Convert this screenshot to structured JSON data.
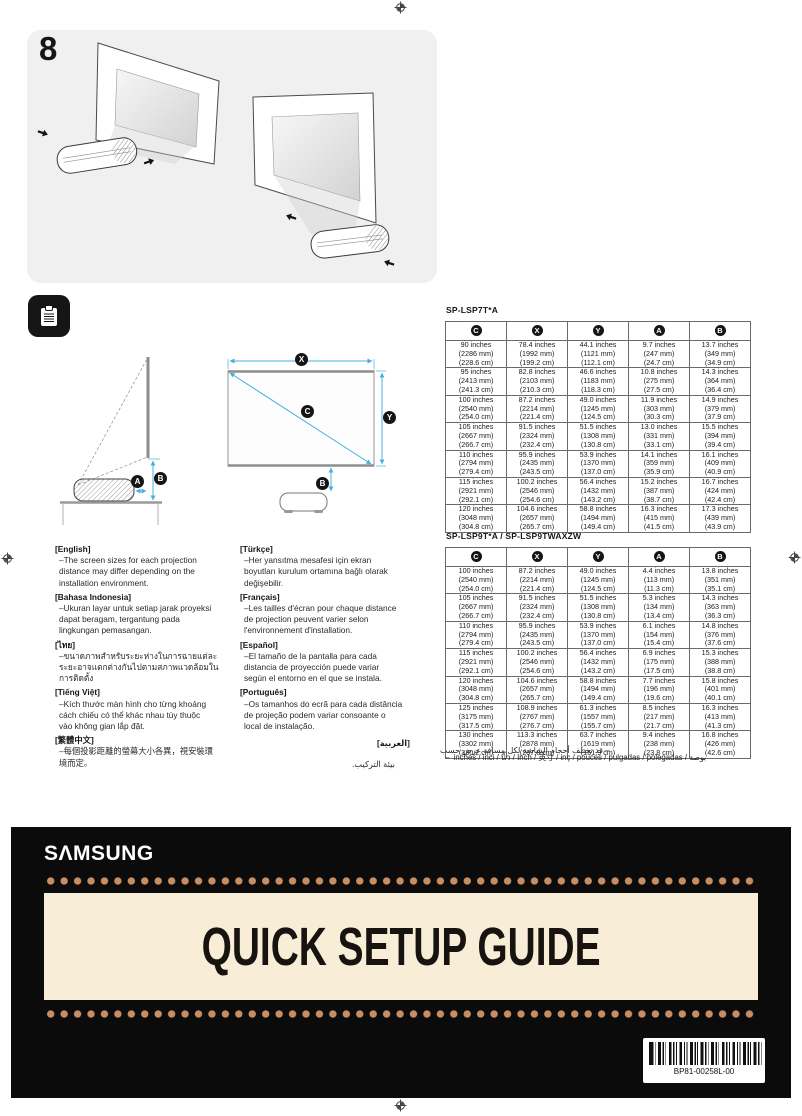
{
  "step": {
    "number": "8"
  },
  "diagram": {
    "accent_color": "#45b0e0",
    "labels": {
      "c": "C",
      "x": "X",
      "y": "Y",
      "a": "A",
      "b": "B"
    }
  },
  "tables": [
    {
      "model": "SP-LSP7T*A",
      "columns": [
        "C",
        "X",
        "Y",
        "A",
        "B"
      ],
      "rows": [
        [
          [
            "90 inches",
            "(2286 mm)",
            "(228.6 cm)"
          ],
          [
            "78.4 inches",
            "(1992 mm)",
            "(199.2 cm)"
          ],
          [
            "44.1 inches",
            "(1121 mm)",
            "(112.1 cm)"
          ],
          [
            "9.7 inches",
            "(247 mm)",
            "(24.7 cm)"
          ],
          [
            "13.7 inches",
            "(349 mm)",
            "(34.9 cm)"
          ]
        ],
        [
          [
            "95 inches",
            "(2413 mm)",
            "(241.3 cm)"
          ],
          [
            "82.8 inches",
            "(2103 mm)",
            "(210.3 cm)"
          ],
          [
            "46.6 inches",
            "(1183 mm)",
            "(118.3 cm)"
          ],
          [
            "10.8 inches",
            "(275 mm)",
            "(27.5 cm)"
          ],
          [
            "14.3 inches",
            "(364 mm)",
            "(36.4 cm)"
          ]
        ],
        [
          [
            "100 inches",
            "(2540 mm)",
            "(254.0 cm)"
          ],
          [
            "87.2 inches",
            "(2214 mm)",
            "(221.4 cm)"
          ],
          [
            "49.0 inches",
            "(1245 mm)",
            "(124.5 cm)"
          ],
          [
            "11.9 inches",
            "(303 mm)",
            "(30.3 cm)"
          ],
          [
            "14.9 inches",
            "(379 mm)",
            "(37.9 cm)"
          ]
        ],
        [
          [
            "105 inches",
            "(2667 mm)",
            "(266.7 cm)"
          ],
          [
            "91.5 inches",
            "(2324 mm)",
            "(232.4 cm)"
          ],
          [
            "51.5 inches",
            "(1308 mm)",
            "(130.8 cm)"
          ],
          [
            "13.0 inches",
            "(331 mm)",
            "(33.1 cm)"
          ],
          [
            "15.5 inches",
            "(394 mm)",
            "(39.4 cm)"
          ]
        ],
        [
          [
            "110 inches",
            "(2794 mm)",
            "(279.4 cm)"
          ],
          [
            "95.9 inches",
            "(2435 mm)",
            "(243.5 cm)"
          ],
          [
            "53.9 inches",
            "(1370 mm)",
            "(137.0 cm)"
          ],
          [
            "14.1 inches",
            "(359 mm)",
            "(35.9 cm)"
          ],
          [
            "16.1 inches",
            "(409 mm)",
            "(40.9 cm)"
          ]
        ],
        [
          [
            "115 inches",
            "(2921 mm)",
            "(292.1 cm)"
          ],
          [
            "100.2 inches",
            "(2546 mm)",
            "(254.6 cm)"
          ],
          [
            "56.4 inches",
            "(1432 mm)",
            "(143.2 cm)"
          ],
          [
            "15.2 inches",
            "(387 mm)",
            "(38.7 cm)"
          ],
          [
            "16.7 inches",
            "(424 mm)",
            "(42.4 cm)"
          ]
        ],
        [
          [
            "120 inches",
            "(3048 mm)",
            "(304.8 cm)"
          ],
          [
            "104.6 inches",
            "(2657 mm)",
            "(265.7 cm)"
          ],
          [
            "58.8 inches",
            "(1494 mm)",
            "(149.4 cm)"
          ],
          [
            "16.3 inches",
            "(415 mm)",
            "(41.5 cm)"
          ],
          [
            "17.3 inches",
            "(439 mm)",
            "(43.9 cm)"
          ]
        ]
      ]
    },
    {
      "model": "SP-LSP9T*A / SP-LSP9TWAXZW",
      "columns": [
        "C",
        "X",
        "Y",
        "A",
        "B"
      ],
      "rows": [
        [
          [
            "100 inches",
            "(2540 mm)",
            "(254.0 cm)"
          ],
          [
            "87.2 inches",
            "(2214 mm)",
            "(221.4 cm)"
          ],
          [
            "49.0 inches",
            "(1245 mm)",
            "(124.5 cm)"
          ],
          [
            "4.4 inches",
            "(113 mm)",
            "(11.3 cm)"
          ],
          [
            "13.8 inches",
            "(351 mm)",
            "(35.1 cm)"
          ]
        ],
        [
          [
            "105 inches",
            "(2667 mm)",
            "(266.7 cm)"
          ],
          [
            "91.5 inches",
            "(2324 mm)",
            "(232.4 cm)"
          ],
          [
            "51.5 inches",
            "(1308 mm)",
            "(130.8 cm)"
          ],
          [
            "5.3 inches",
            "(134 mm)",
            "(13.4 cm)"
          ],
          [
            "14.3 inches",
            "(363 mm)",
            "(36.3 cm)"
          ]
        ],
        [
          [
            "110 inches",
            "(2794 mm)",
            "(279.4 cm)"
          ],
          [
            "95.9 inches",
            "(2435 mm)",
            "(243.5 cm)"
          ],
          [
            "53.9 inches",
            "(1370 mm)",
            "(137.0 cm)"
          ],
          [
            "6.1 inches",
            "(154 mm)",
            "(15.4 cm)"
          ],
          [
            "14.8 inches",
            "(376 mm)",
            "(37.6 cm)"
          ]
        ],
        [
          [
            "115 inches",
            "(2921 mm)",
            "(292.1 cm)"
          ],
          [
            "100.2 inches",
            "(2546 mm)",
            "(254.6 cm)"
          ],
          [
            "56.4 inches",
            "(1432 mm)",
            "(143.2 cm)"
          ],
          [
            "6.9 inches",
            "(175 mm)",
            "(17.5 cm)"
          ],
          [
            "15.3 inches",
            "(388 mm)",
            "(38.8 cm)"
          ]
        ],
        [
          [
            "120 inches",
            "(3048 mm)",
            "(304.8 cm)"
          ],
          [
            "104.6 inches",
            "(2657 mm)",
            "(265.7 cm)"
          ],
          [
            "58.8 inches",
            "(1494 mm)",
            "(149.4 cm)"
          ],
          [
            "7.7 inches",
            "(196 mm)",
            "(19.6 cm)"
          ],
          [
            "15.8 inches",
            "(401 mm)",
            "(40.1 cm)"
          ]
        ],
        [
          [
            "125 inches",
            "(3175 mm)",
            "(317.5 cm)"
          ],
          [
            "108.9 inches",
            "(2767 mm)",
            "(276.7 cm)"
          ],
          [
            "61.3 inches",
            "(1557 mm)",
            "(155.7 cm)"
          ],
          [
            "8.5 inches",
            "(217 mm)",
            "(21.7 cm)"
          ],
          [
            "16.3 inches",
            "(413 mm)",
            "(41.3 cm)"
          ]
        ],
        [
          [
            "130 inches",
            "(3302 mm)",
            "(330.2 cm)"
          ],
          [
            "113.3 inches",
            "(2878 mm)",
            "(287.8 cm)"
          ],
          [
            "63.7 inches",
            "(1619 mm)",
            "(161.9 cm)"
          ],
          [
            "9.4 inches",
            "(238 mm)",
            "(23.8 cm)"
          ],
          [
            "16.8 inches",
            "(426 mm)",
            "(42.6 cm)"
          ]
        ]
      ]
    }
  ],
  "languages": {
    "left": [
      {
        "heading": "[English]",
        "lines": [
          "–The screen sizes for each projection",
          "distance may differ depending on the",
          "installation environment."
        ]
      },
      {
        "heading": "[Bahasa Indonesia]",
        "lines": [
          "–Ukuran layar untuk setiap jarak proyeksi",
          "dapat beragam, tergantung pada",
          "lingkungan pemasangan."
        ]
      },
      {
        "heading": "[ไทย]",
        "lines": [
          "–ขนาดภาพสำหรับระยะห่างในการฉายแต่ละ",
          "ระยะอาจแตกต่างกันไปตามสภาพแวดล้อมใน",
          "การติดตั้ง"
        ]
      },
      {
        "heading": "[Tiếng Việt]",
        "lines": [
          "–Kích thước màn hình cho từng khoảng",
          "cách chiếu có thể khác nhau tùy thuộc",
          "vào không gian lắp đặt."
        ]
      },
      {
        "heading": "[繁體中文]",
        "lines": [
          "–每個投影距離的螢幕大小各異，視安裝環",
          "境而定。"
        ]
      }
    ],
    "middle": [
      {
        "heading": "[Türkçe]",
        "lines": [
          "–Her yansıtma mesafesi için ekran",
          "boyutları kurulum ortamına bağlı olarak",
          "değişebilir."
        ]
      },
      {
        "heading": "[Français]",
        "lines": [
          "–Les tailles d'écran pour chaque distance",
          "de projection peuvent varier selon",
          "l'environnement d'installation."
        ]
      },
      {
        "heading": "[Español]",
        "lines": [
          "–El tamaño de la pantalla para cada",
          "distancia de proyección puede variar",
          "según el entorno en el que se instala."
        ]
      },
      {
        "heading": "[Português]",
        "lines": [
          "–Os tamanhos do ecrã para cada distância",
          "de projeção podem variar consoante o",
          "local de instalação."
        ]
      }
    ],
    "arabic": {
      "heading": "[العربية]",
      "line1": "– قد تختلف أحجام الشاشة لكل مسافة عرض حسب",
      "line2": "بيئة التركيب."
    }
  },
  "footnote": "–  inches / inci / นิ้ว / Inch / 英寸 / inç / pouces / pulgadas / polegadas / بوصة",
  "banner": {
    "brand": "SΛMSUNG",
    "title": "QUICK SETUP GUIDE",
    "barcode_text": "BP81-00258L-00",
    "colors": {
      "background": "#0b0b0b",
      "dots": "#c68e62",
      "panel": "#f8eed8",
      "title_text": "#17130e"
    }
  }
}
